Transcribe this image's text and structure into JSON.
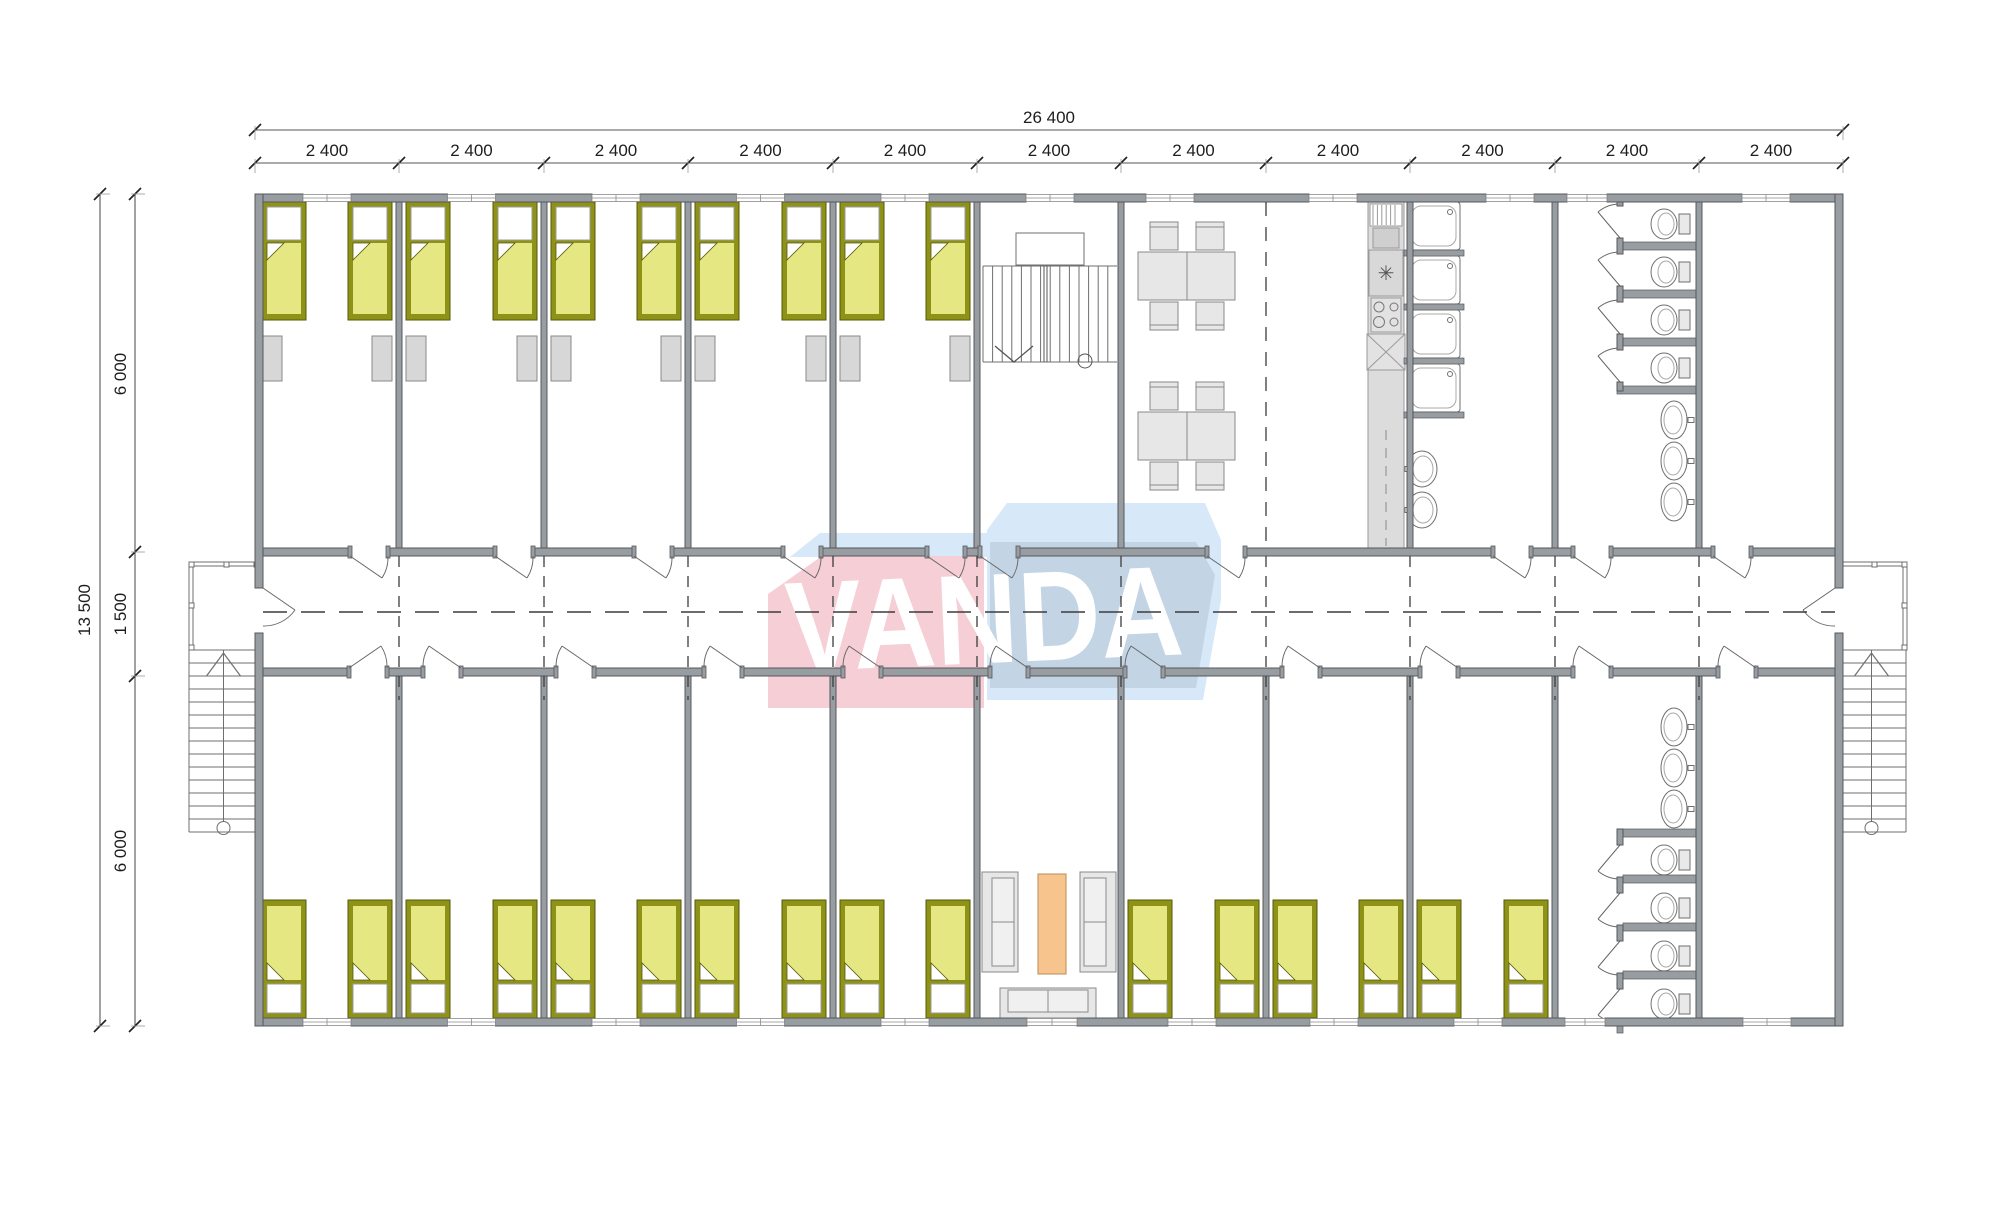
{
  "plan": {
    "watermark_text": "VANDA",
    "dimensions": {
      "overall_width_label": "26 400",
      "module_width_labels": [
        "2 400",
        "2 400",
        "2 400",
        "2 400",
        "2 400",
        "2 400",
        "2 400",
        "2 400",
        "2 400",
        "2 400",
        "2 400"
      ],
      "overall_height_label": "13 500",
      "height_segment_labels": [
        "6 000",
        "1 500",
        "6 000"
      ]
    },
    "stove_symbol": "✳",
    "colors": {
      "wall_fill": "#989da2",
      "wall_edge": "#55585c",
      "fixture_line": "#6f6f6f",
      "furniture_fill": "#e7e7e7",
      "furniture_edge": "#8a8a8a",
      "locker_fill": "#d7d7d7",
      "bed_frame": "#8e9317",
      "bed_frame_edge": "#555908",
      "bed_mattress": "#e5e783",
      "pillow_fill": "#ffffff",
      "coffee_table_fill": "#f8c48e",
      "coffee_table_edge": "#bb8b55",
      "counter_fill": "#dcdcdc",
      "logo_pink": "#f5ced6",
      "logo_blue": "#d7e9f8",
      "logo_blue_deep": "#c3d4e4",
      "dash_line": "#3c3c3c",
      "dim_line": "#555555",
      "dim_text": "#1d1d1d"
    }
  }
}
